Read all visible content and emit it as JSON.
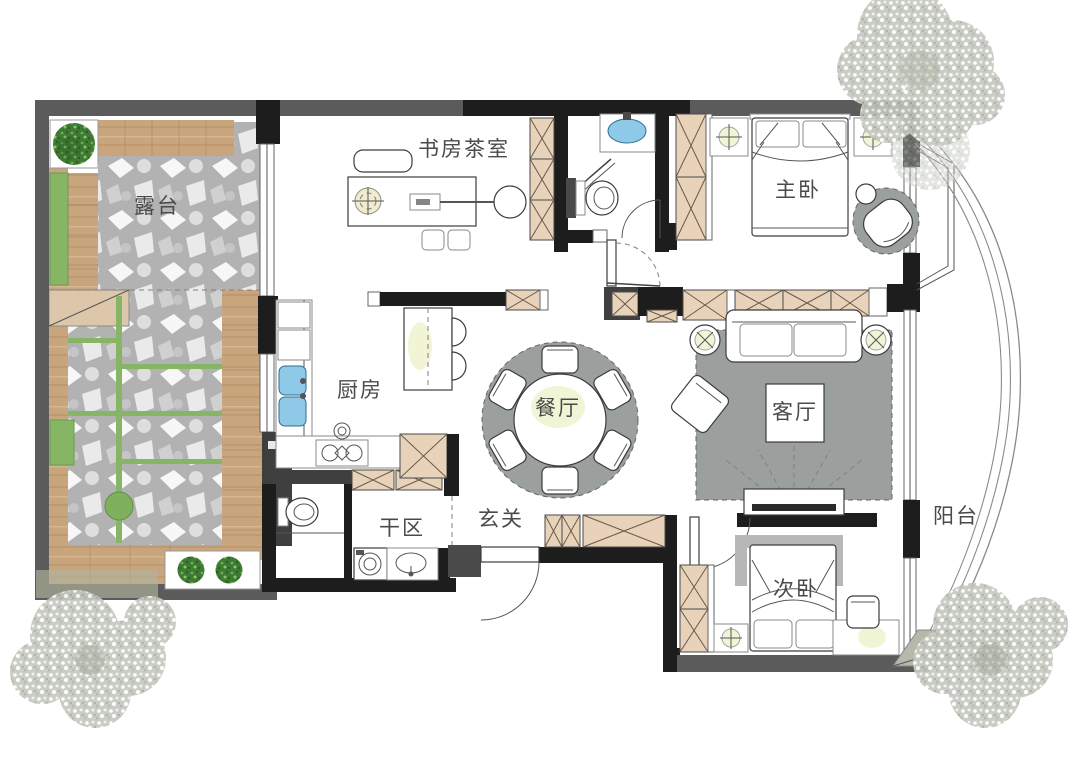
{
  "plan": {
    "rooms": [
      {
        "id": "terrace",
        "label": "露台"
      },
      {
        "id": "study_tea_room",
        "label": "书房茶室"
      },
      {
        "id": "master_bedroom",
        "label": "主卧"
      },
      {
        "id": "kitchen",
        "label": "厨房"
      },
      {
        "id": "dining_room",
        "label": "餐厅"
      },
      {
        "id": "living_room",
        "label": "客厅"
      },
      {
        "id": "entryway",
        "label": "玄关"
      },
      {
        "id": "dry_area",
        "label": "干区"
      },
      {
        "id": "second_bedroom",
        "label": "次卧"
      },
      {
        "id": "balcony",
        "label": "阳台"
      }
    ],
    "colors": {
      "wall_black": "#1d1d1d",
      "wall_gray": "#5b5b5b",
      "wood": "#c9a57d",
      "cabinet_fill": "#e8d3ba",
      "stone": "#b2b2b2",
      "grass_green": "#86b565",
      "rug_gray": "#9b9f9e",
      "sink_blue": "#8ec9e8",
      "lamp_glow": "#f0f4d2",
      "tree_gray": "#c6cac1",
      "tree_green": "#3e7a33"
    }
  }
}
